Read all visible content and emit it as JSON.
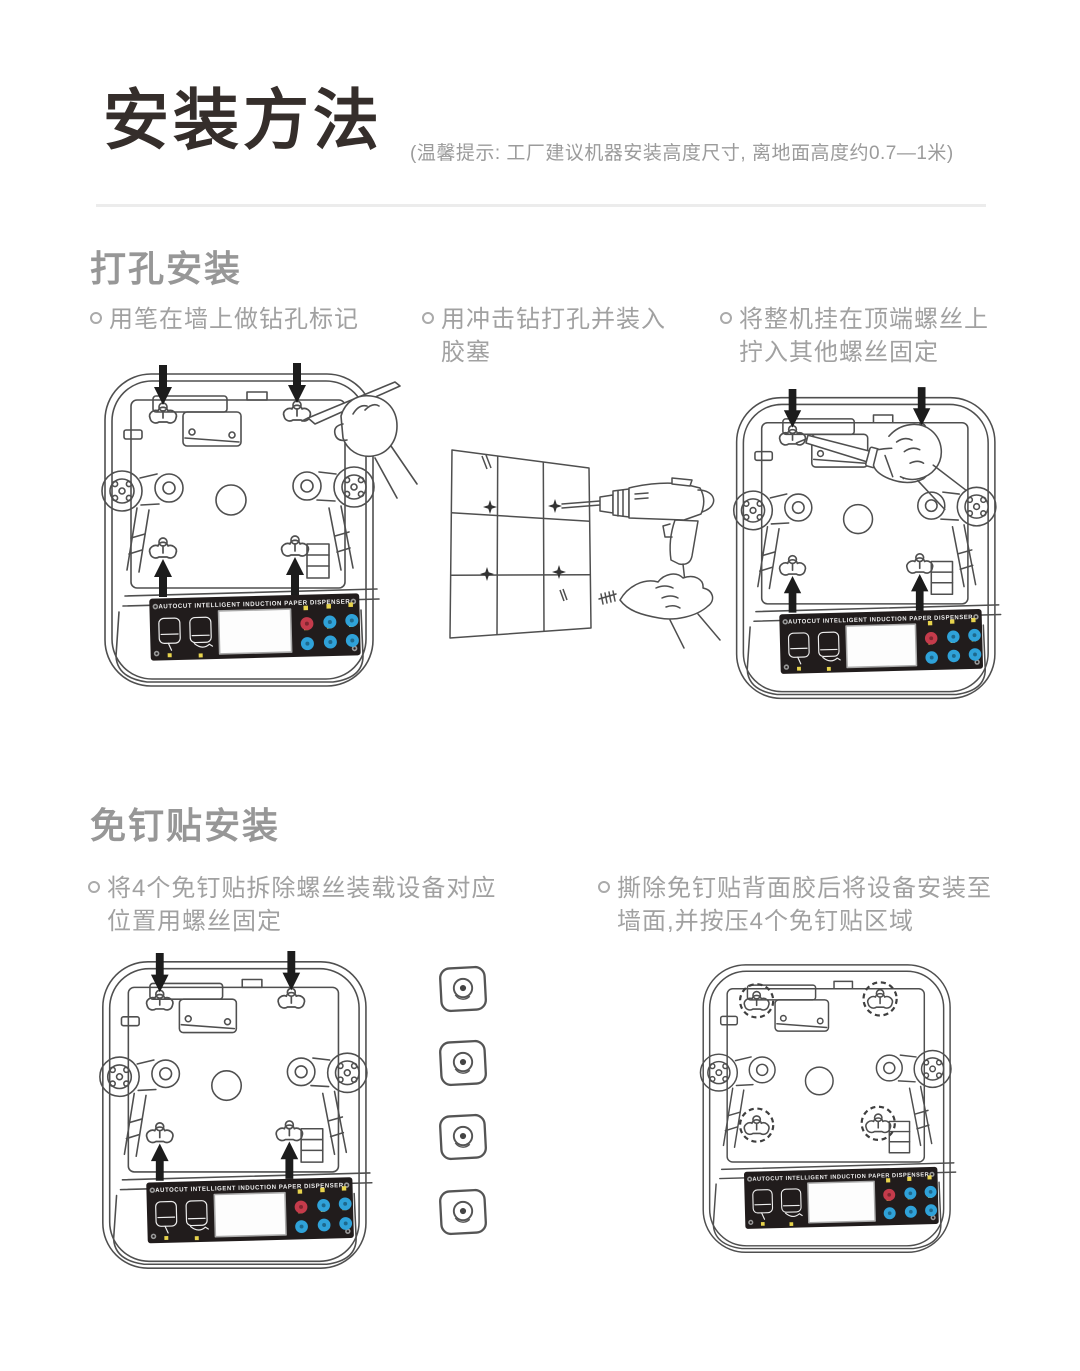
{
  "page": {
    "title": "安装方法",
    "note": "(温馨提示: 工厂建议机器安装高度尺寸, 离地面高度约0.7—1米)"
  },
  "sections": [
    {
      "heading": "打孔安装",
      "steps": [
        {
          "line1": "用笔在墙上做钻孔标记",
          "line2": ""
        },
        {
          "line1": "用冲击钻打孔并装入",
          "line2": "胶塞"
        },
        {
          "line1": "将整机挂在顶端螺丝上",
          "line2": "拧入其他螺丝固定"
        }
      ]
    },
    {
      "heading": "免钉贴安装",
      "steps": [
        {
          "line1": "将4个免钉贴拆除螺丝装载设备对应",
          "line2": "位置用螺丝固定"
        },
        {
          "line1": "撕除免钉贴背面胶后将设备安装至",
          "line2": "墙面,并按压4个免钉贴区域"
        }
      ]
    }
  ],
  "device_panel": {
    "label": "AUTOCUT INTELLIGENT INDUCTION PAPER DISPENSER"
  },
  "colors": {
    "title_dark": "#352e2b",
    "text_gray": "#a1a1a1",
    "heading_gray": "#979797",
    "line_art": "#4f4f4f",
    "panel_black": "#211c1c",
    "button_blue": "#2fa2d9",
    "button_red": "#c43b4b",
    "indicator_yellow": "#e8d44d"
  }
}
